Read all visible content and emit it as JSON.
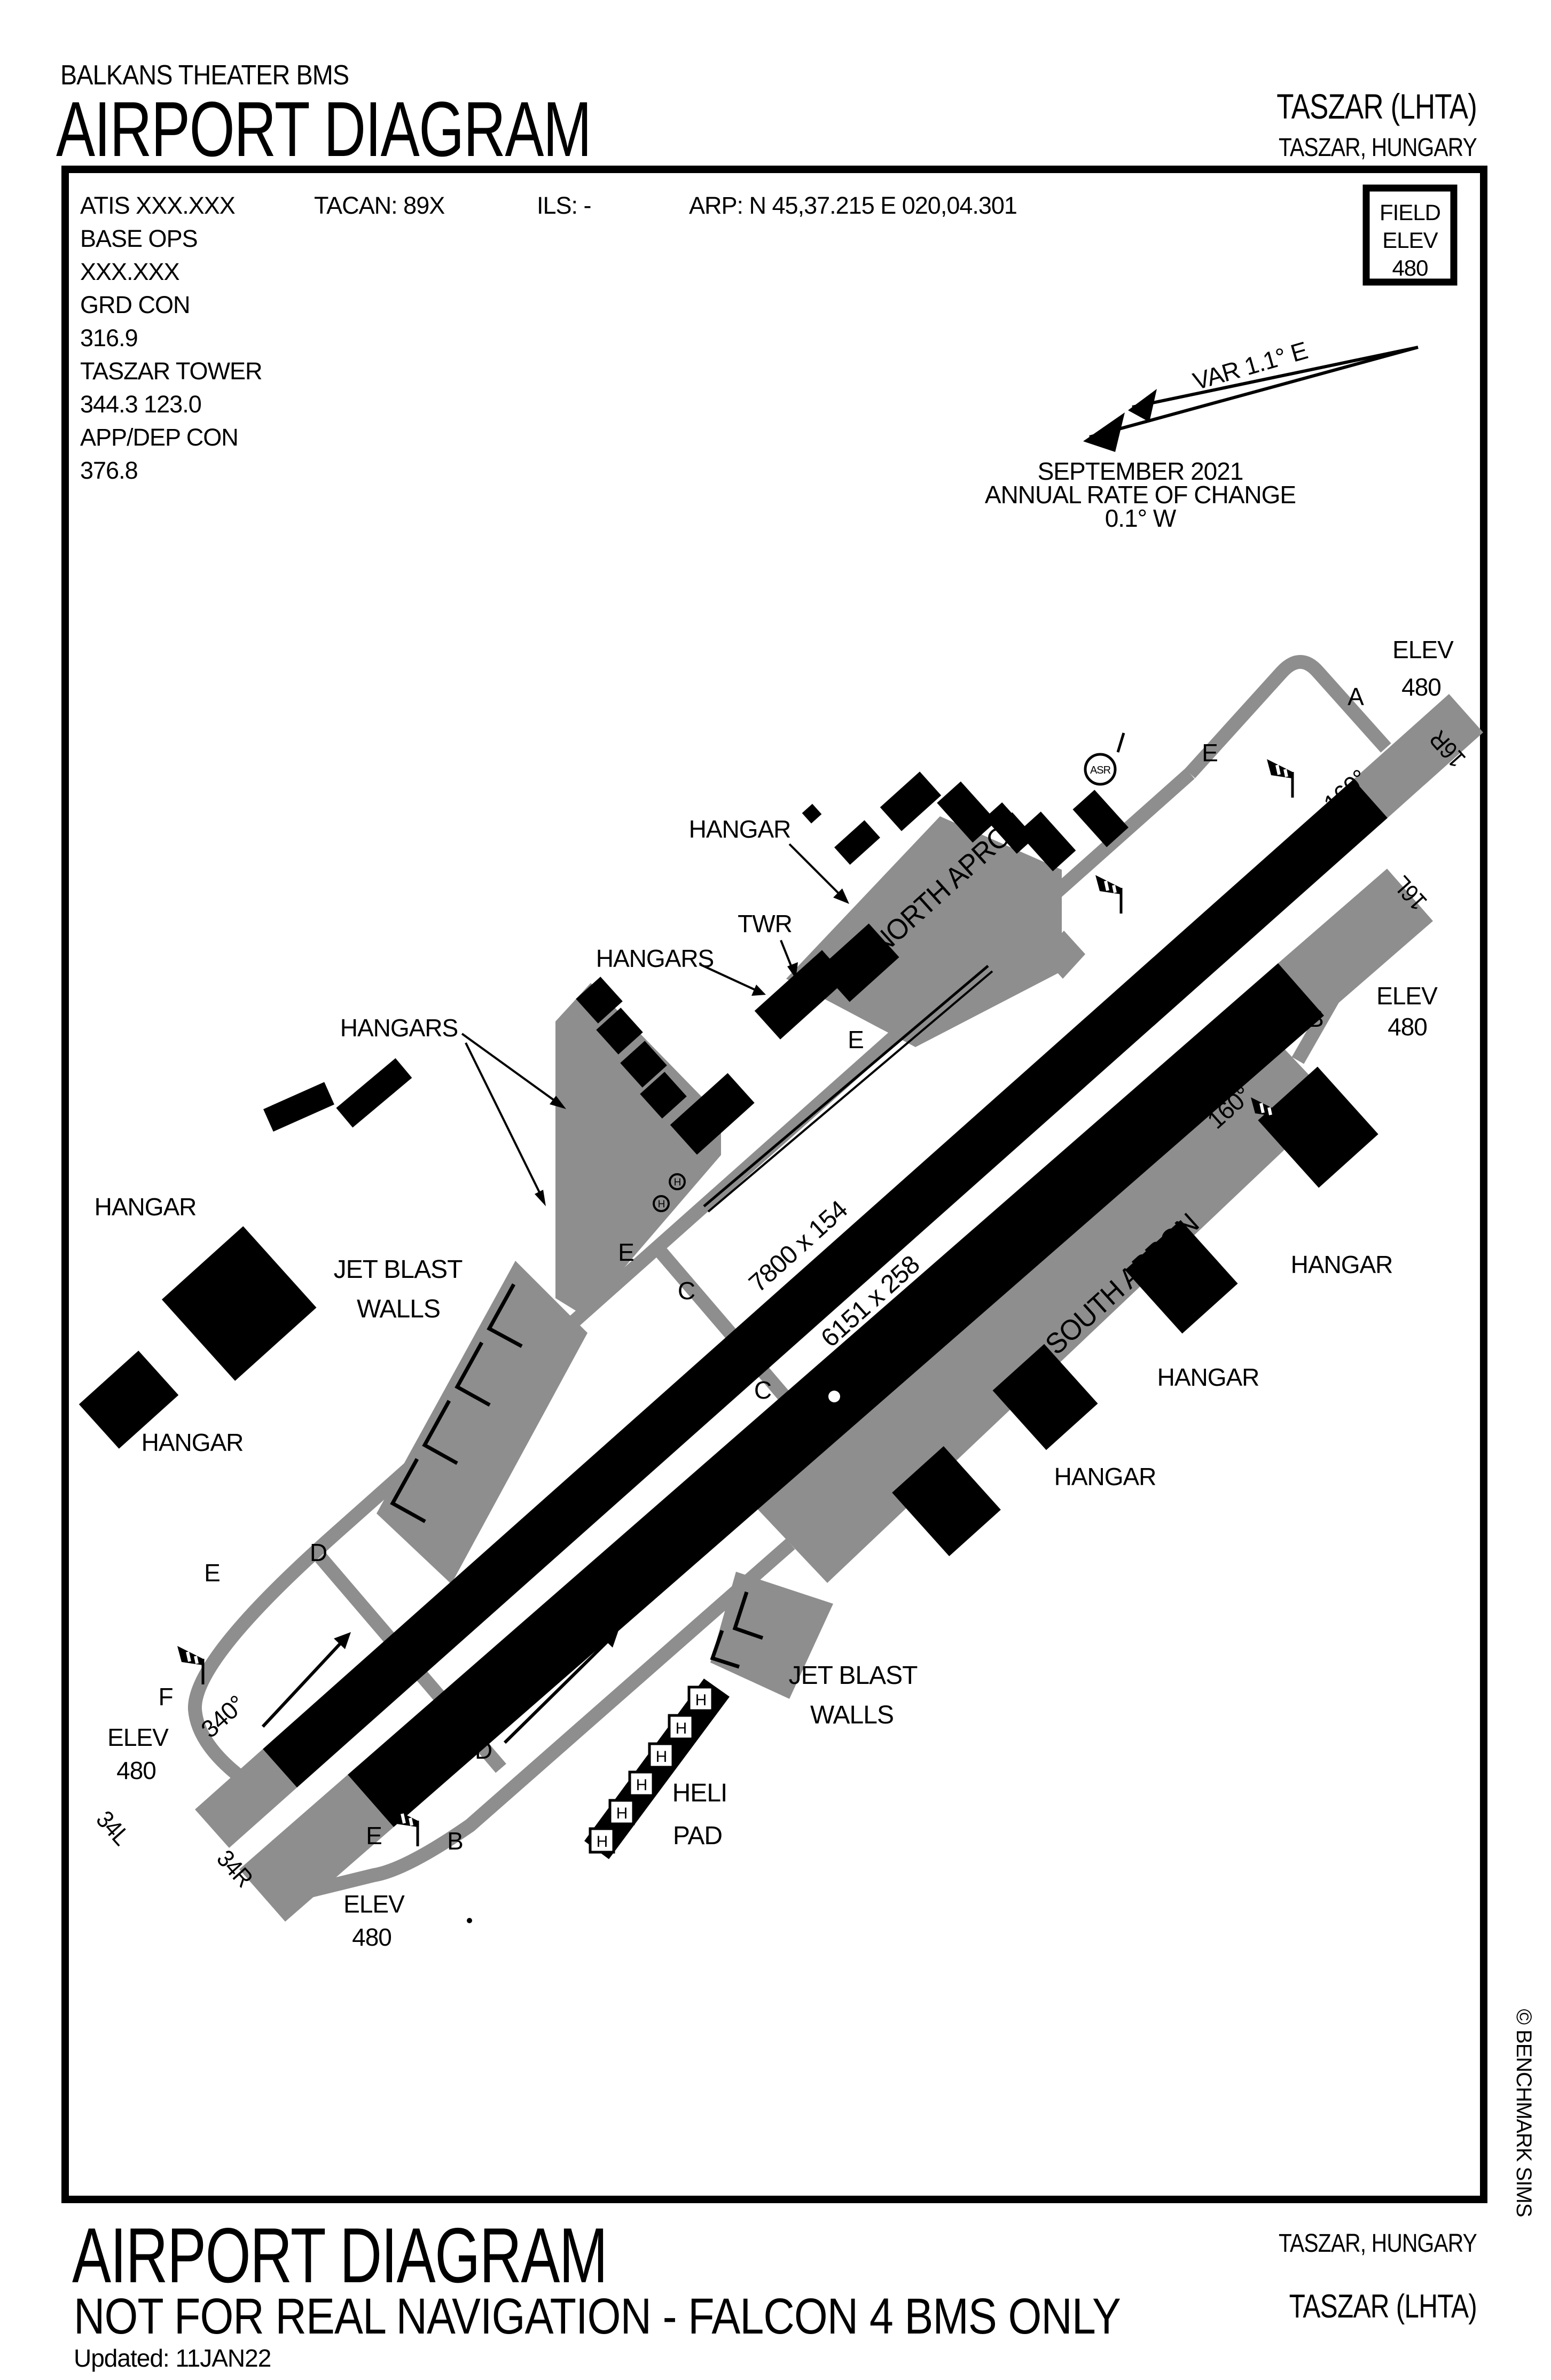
{
  "header": {
    "theater": "BALKANS THEATER BMS",
    "title": "AIRPORT DIAGRAM",
    "airport": "TASZAR (LHTA)",
    "location": "TASZAR, HUNGARY"
  },
  "comms": {
    "atis": "ATIS   XXX.XXX",
    "tacan": "TACAN: 89X",
    "ils": "ILS: -",
    "arp": "ARP: N 45,37.215  E 020,04.301",
    "lines": [
      "BASE OPS",
      "XXX.XXX",
      "GRD CON",
      "316.9",
      "TASZAR TOWER",
      "344.3   123.0",
      "APP/DEP CON",
      "376.8"
    ]
  },
  "field_elev": {
    "title": "FIELD",
    "label": "ELEV",
    "value": "480"
  },
  "variation": {
    "text": "VAR 1.1° E",
    "date": "SEPTEMBER 2021",
    "rate_label": "ANNUAL RATE OF CHANGE",
    "rate_value": "0.1° W"
  },
  "diagram": {
    "runways": [
      {
        "id": "16R/34L",
        "dim": "7800 x 154",
        "end_a": "16R",
        "end_b": "34L",
        "heading_a": "160°",
        "heading_b": "340°"
      },
      {
        "id": "16L/34R",
        "dim": "6151 x 258",
        "end_a": "16L",
        "end_b": "34R",
        "heading_a": "160°",
        "heading_b": "340°"
      }
    ],
    "elev_label": "ELEV",
    "elev_value": "480",
    "aprons": [
      "NORTH APRON",
      "SOUTH APRON"
    ],
    "taxiway_labels": [
      "A",
      "E",
      "E",
      "E",
      "E",
      "E",
      "C",
      "C",
      "C",
      "D",
      "D",
      "D",
      "B",
      "B",
      "F"
    ],
    "hangar_labels": [
      "HANGAR",
      "HANGAR",
      "HANGAR",
      "HANGAR",
      "HANGAR",
      "HANGAR",
      "HANGARS",
      "HANGARS",
      "TWR"
    ],
    "jet_blast": "JET BLAST",
    "walls": "WALLS",
    "heli": "HELI",
    "pad": "PAD",
    "asr": "ASR",
    "helipad_h": "H",
    "copyright": "© BENCHMARK SIMS"
  },
  "footer": {
    "title": "AIRPORT DIAGRAM",
    "disclaimer": "NOT FOR REAL NAVIGATION - FALCON 4 BMS ONLY",
    "updated": "Updated: 11JAN22",
    "location": "TASZAR, HUNGARY",
    "airport": "TASZAR (LHTA)"
  }
}
